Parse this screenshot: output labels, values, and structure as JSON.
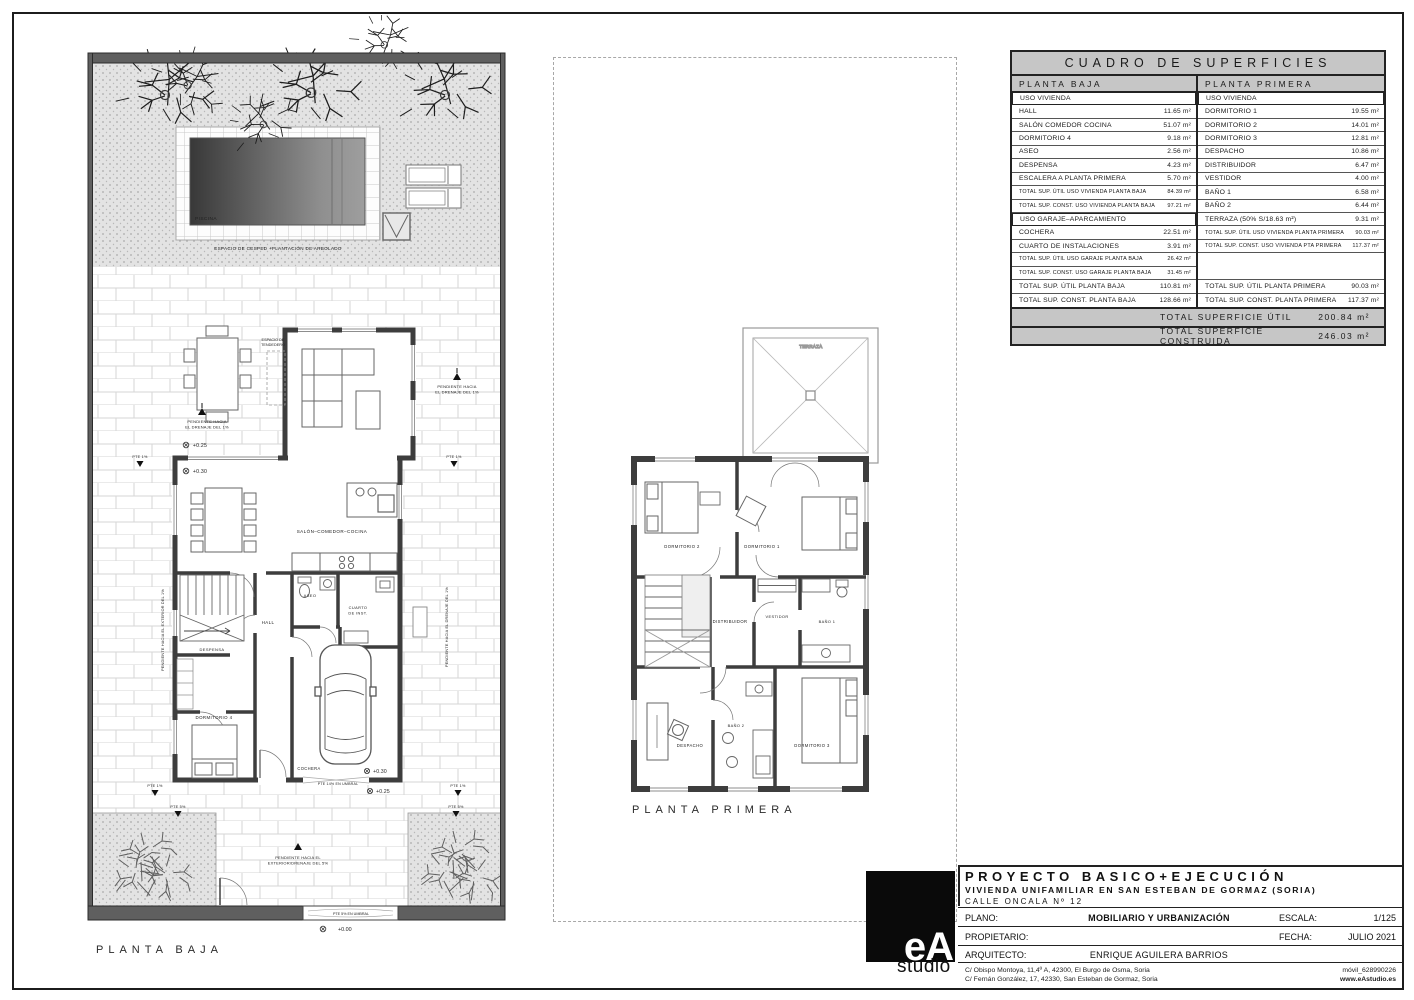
{
  "sheet": {
    "ground_floor_title": "PLANTA BAJA",
    "first_floor_title": "PLANTA PRIMERA"
  },
  "ground_floor": {
    "pool_label": "PISCINA",
    "lawn_label": "ESPACIO DE CESPED +PLANTACIÓN DE ARBOLADO",
    "tendedero_line1": "ESPACIO DE",
    "tendedero_line2": "TENDEDERO",
    "salon_label": "SALÓN–COMEDOR–COCINA",
    "hall_label": "HALL",
    "aseo_label": "ASEO",
    "cuarto_line1": "CUARTO",
    "cuarto_line2": "DE INST.",
    "despensa_label": "DESPENSA",
    "dormitorio4_label": "DORMITORIO 4",
    "cochera_label": "COCHERA",
    "pend_drenaje_line1": "PENDIENTE HACIA",
    "pend_drenaje_line2": "EL DRENAJE  DEL 1%",
    "pend_exterior_line1": "PENDIENTE HACIA EL",
    "pend_exterior_line2": "EXTERIOR/DRENAJE  DEL 5%",
    "pend_exterior_rot": "PENDIENTE HACIA EL EXTERIOR DEL 1%",
    "pend_drenaje_rot": "PENDIENTE HACIA EL DRENAJE DEL 1%",
    "pte1_label": "PTE 1%",
    "pte5_label": "PTE 5%",
    "pte14_umbral_label": "PTE 14% EN UMBRAL",
    "pte5_umbral_label": "PTE 5% EN UMBRAL",
    "level_000": "+0.00",
    "level_025": "+0.25",
    "level_030": "+0.30"
  },
  "first_floor": {
    "terraza_label": "TERRAZA",
    "dormitorio1_label": "DORMITORIO 1",
    "dormitorio2_label": "DORMITORIO 2",
    "dormitorio3_label": "DORMITORIO 3",
    "despacho_label": "DESPACHO",
    "distribuidor_label": "DISTRIBUIDOR",
    "vestidor_label": "VESTIDOR",
    "bano1_label": "BAÑO 1",
    "bano2_label": "BAÑO 2"
  },
  "surface_table": {
    "title": "CUADRO DE SUPERFICIES",
    "left_header": "PLANTA BAJA",
    "right_header": "PLANTA PRIMERA",
    "left_rows": [
      {
        "label": "USO VIVIENDA",
        "value": ""
      },
      {
        "label": "HALL",
        "value": "11.65 m²"
      },
      {
        "label": "SALÓN COMEDOR COCINA",
        "value": "51.07 m²"
      },
      {
        "label": "DORMITORIO 4",
        "value": "9.18 m²"
      },
      {
        "label": "ASEO",
        "value": "2.56 m²"
      },
      {
        "label": "DESPENSA",
        "value": "4.23 m²"
      },
      {
        "label": "ESCALERA A PLANTA PRIMERA",
        "value": "5.70 m²"
      },
      {
        "label": "TOTAL SUP. ÚTIL USO VIVIENDA PLANTA BAJA",
        "value": "84.39 m²"
      },
      {
        "label": "TOTAL SUP. CONST. USO VIVIENDA PLANTA BAJA",
        "value": "97.21 m²"
      },
      {
        "label": "USO GARAJE–APARCAMIENTO",
        "value": ""
      },
      {
        "label": "COCHERA",
        "value": "22.51 m²"
      },
      {
        "label": "CUARTO DE INSTALACIONES",
        "value": "3.91 m²"
      },
      {
        "label": "TOTAL SUP. ÚTIL USO GARAJE PLANTA BAJA",
        "value": "26.42 m²"
      },
      {
        "label": "TOTAL SUP. CONST. USO GARAJE PLANTA BAJA",
        "value": "31.45 m²"
      },
      {
        "label": "TOTAL SUP. ÚTIL PLANTA BAJA",
        "value": "110.81 m²"
      },
      {
        "label": "TOTAL SUP. CONST. PLANTA BAJA",
        "value": "128.66 m²"
      }
    ],
    "right_rows": [
      {
        "label": "USO VIVIENDA",
        "value": ""
      },
      {
        "label": "DORMITORIO 1",
        "value": "19.55 m²"
      },
      {
        "label": "DORMITORIO 2",
        "value": "14.01 m²"
      },
      {
        "label": "DORMITORIO 3",
        "value": "12.81 m²"
      },
      {
        "label": "DESPACHO",
        "value": "10.86 m²"
      },
      {
        "label": "DISTRIBUIDOR",
        "value": "6.47 m²"
      },
      {
        "label": "VESTIDOR",
        "value": "4.00 m²"
      },
      {
        "label": "BAÑO 1",
        "value": "6.58 m²"
      },
      {
        "label": "BAÑO 2",
        "value": "6.44 m²"
      },
      {
        "label": "TERRAZA (50% S/18.63 m²)",
        "value": "9.31 m²"
      },
      {
        "label": "TOTAL SUP. ÚTIL USO VIVIENDA PLANTA PRIMERA",
        "value": "90.03 m²"
      },
      {
        "label": "TOTAL SUP. CONST. USO VIVIENDA PTA PRIMERA",
        "value": "117.37 m²"
      },
      {
        "label": "",
        "value": ""
      },
      {
        "label": "TOTAL SUP. ÚTIL PLANTA PRIMERA",
        "value": "90.03 m²"
      },
      {
        "label": "TOTAL SUP. CONST. PLANTA PRIMERA",
        "value": "117.37 m²"
      }
    ],
    "totals": [
      {
        "label": "TOTAL SUPERFICIE ÚTIL",
        "value": "200.84 m²"
      },
      {
        "label": "TOTAL SUPERFICIE CONSTRUIDA",
        "value": "246.03 m²"
      }
    ]
  },
  "title_block": {
    "logo_text": "eA",
    "logo_sub": "studio",
    "project_line1": "PROYECTO BASICO+EJECUCIÓN",
    "project_line2": "VIVIENDA UNIFAMILIAR EN SAN ESTEBAN DE GORMAZ (SORIA)",
    "project_line3": "CALLE ONCALA Nº 12",
    "plano_label": "PLANO:",
    "plano_value": "MOBILIARIO Y URBANIZACIÓN",
    "escala_label": "ESCALA:",
    "escala_value": "1/125",
    "propietario_label": "PROPIETARIO:",
    "fecha_label": "FECHA:",
    "fecha_value": "JULIO 2021",
    "arquitecto_label": "ARQUITECTO:",
    "arquitecto_value": "ENRIQUE AGUILERA BARRIOS",
    "office_address1": "C/ Obispo Montoya, 11,4º A, 42300, El Burgo de Osma, Soria",
    "office_address2": "C/ Fernán González, 17, 42330, San Esteban de Gormaz, Soria",
    "phone": "móvil_628990226",
    "website": "www.eAstudio.es"
  }
}
